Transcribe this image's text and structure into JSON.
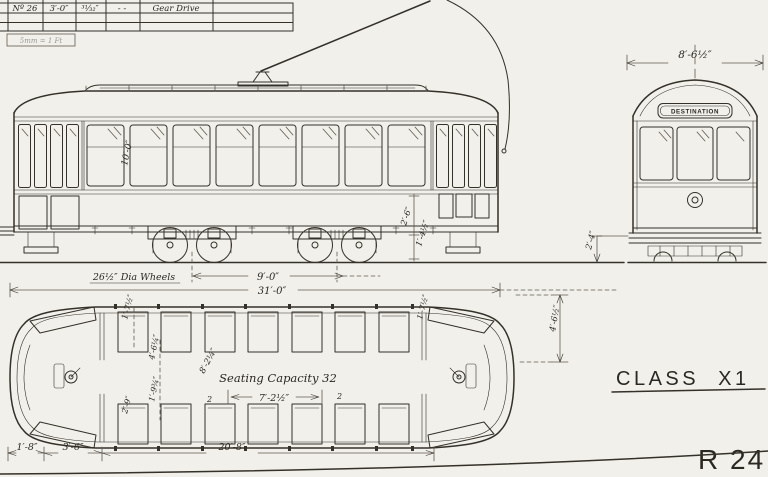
{
  "title_block": {
    "cells": [
      "Nº 26",
      "3′-0″",
      "³¹⁄₃₂″",
      "-  -",
      "Gear Drive"
    ],
    "scale_note": "5mm = 1 Ft"
  },
  "side_elevation": {
    "interior_height": "10′-0″",
    "wheel_note": "26½″ Dia Wheels",
    "truck_centres": "9′-0″",
    "overall_length": "31′-0″",
    "step_height_upper": "2′-6″",
    "step_height_lower": "1′-4½″"
  },
  "end_elevation": {
    "overall_width": "8′-6½″",
    "destination_sign": "DESTINATION",
    "floor_height": "2′-4″"
  },
  "plan_view": {
    "seating_note": "Seating Capacity 32",
    "aisle_dim": "7′-2½″",
    "diagonal_dim": "8′-2¼″",
    "body_width": "4′-6½″",
    "rotated_dims": [
      "1′-7½″",
      "4′-6¼″",
      "1′-9¾″",
      "2′-9″"
    ],
    "seat_marks": [
      "2",
      "2"
    ],
    "bottom_dims": [
      "1′-8″",
      "3′-6″",
      "20′-8″"
    ]
  },
  "sheet": {
    "class_label": "CLASS X1",
    "drawing_number": "R 24"
  }
}
